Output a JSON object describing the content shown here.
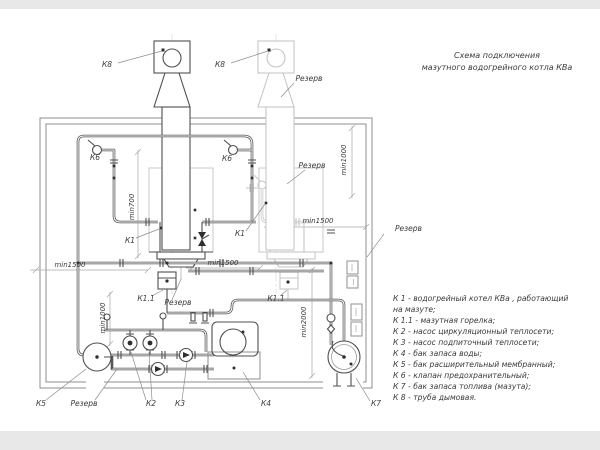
{
  "title": {
    "line1": "Схема подключения",
    "line2": "мазутного водогрейного котла КВа"
  },
  "legend": {
    "lines": [
      "К 1 -  водогрейный котел КВа , работающий",
      "на мазуте;",
      "К 1.1 -  мазутная горелка;",
      "К 2 -  насос циркуляционный теплосети;",
      "К 3 -  насос подпиточный теплосети;",
      "К 4 -  бак запаса воды;",
      "К 5 -  бак расширительный мембранный;",
      "К 6 -  клапан предохранительный;",
      "К 7 -  бак запаса топлива (мазута);",
      "К 8 -  труба дымовая."
    ]
  },
  "component_labels": {
    "k8": "К8",
    "k6": "К6",
    "k1": "К1",
    "k1_1": "К1.1",
    "k2": "К2",
    "k3": "К3",
    "k4": "К4",
    "k5": "К5",
    "k7": "К7"
  },
  "reserve_label": "Резерв",
  "dim_labels": {
    "min700": "min700",
    "min1000": "min1000",
    "min1500": "min1500",
    "min2000": "min2000"
  },
  "colors": {
    "active_line": "#4f4f4f",
    "reserve_line": "#c6c6c6",
    "dimension_line": "#a6a6a6",
    "text": "#3a3a3a",
    "sheet": "#ffffff",
    "page_margin": "#e8e8e8"
  }
}
